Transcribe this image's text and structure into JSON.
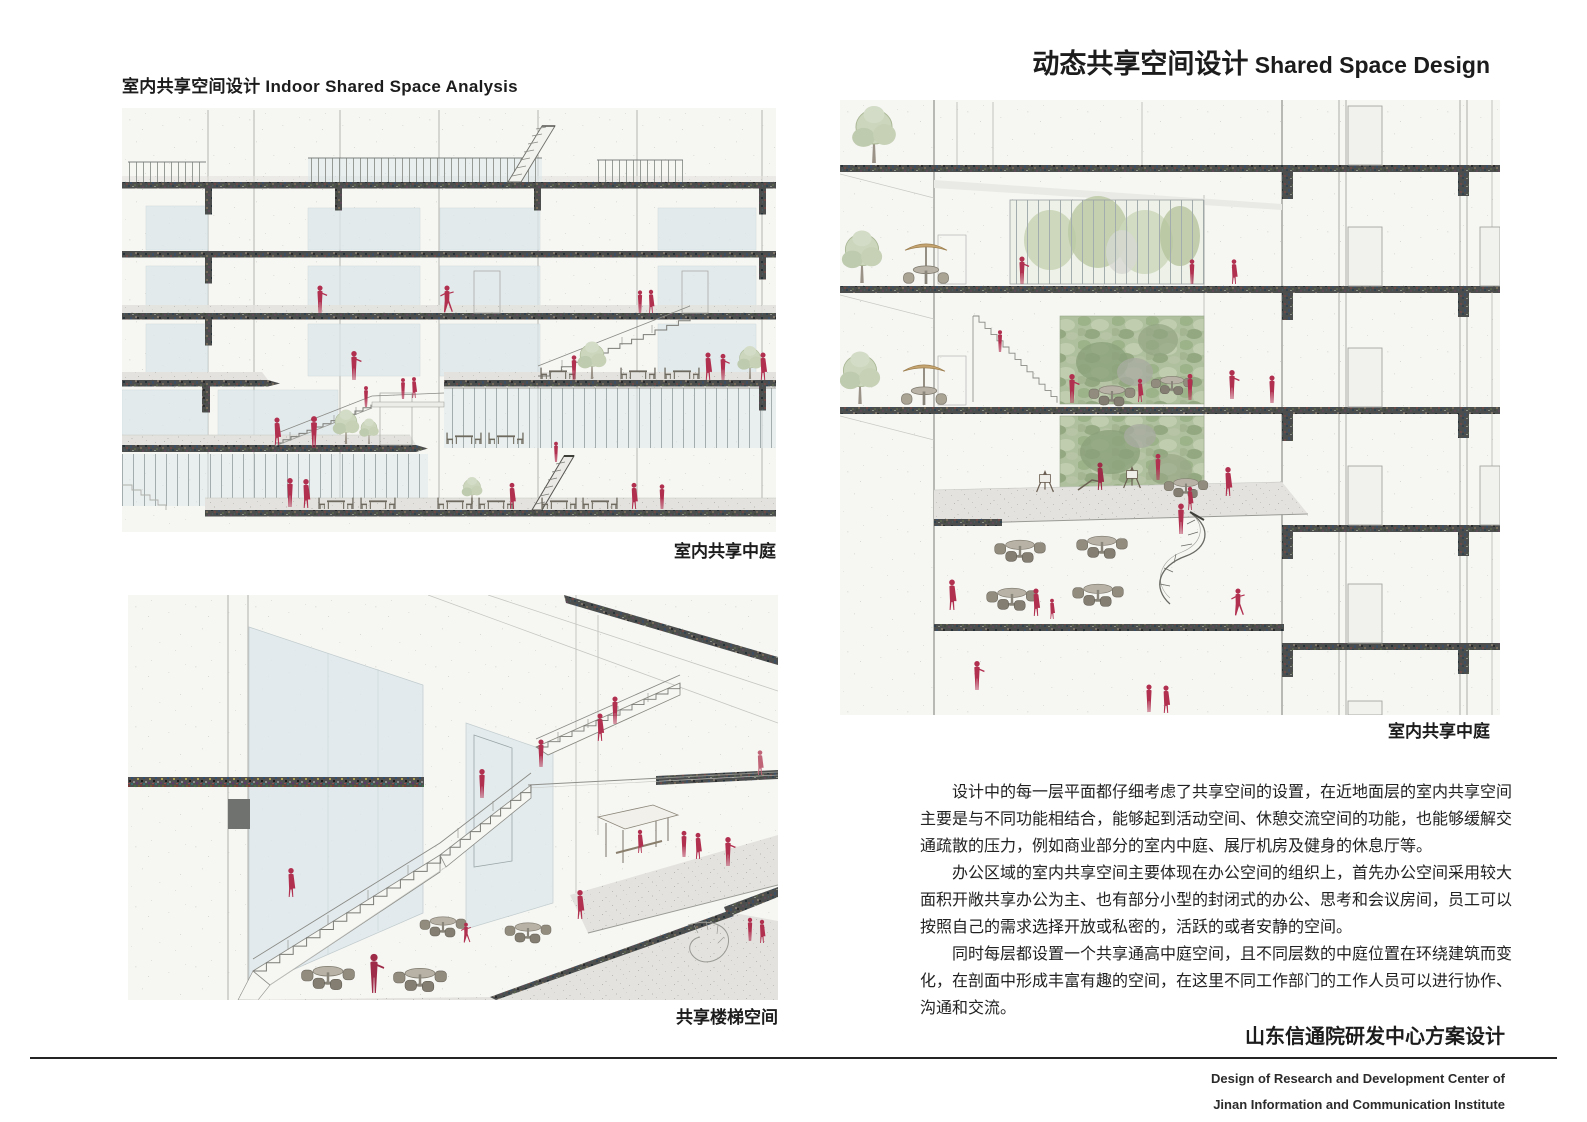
{
  "header": {
    "left_title": "室内共享空间设计 Indoor Shared Space Analysis",
    "right_title_zh": "动态共享空间设计",
    "right_title_en": " Shared Space Design"
  },
  "figures": {
    "atrium_section": {
      "caption": "室内共享中庭"
    },
    "stair_space": {
      "caption": "共享楼梯空间"
    },
    "dynamic_section": {
      "caption": "室内共享中庭"
    }
  },
  "body": {
    "paragraphs": [
      "设计中的每一层平面都仔细考虑了共享空间的设置，在近地面层的室内共享空间主要是与不同功能相结合，能够起到活动空间、休憩交流空间的功能，也能够缓解交通疏散的压力，例如商业部分的室内中庭、展厅机房及健身的休息厅等。",
      "办公区域的室内共享空间主要体现在办公空间的组织上，首先办公空间采用较大面积开敞共享办公为主、也有部分小型的封闭式的办公、思考和会议房间，员工可以按照自己的需求选择开放或私密的，活跃的或者安静的空间。",
      "同时每层都设置一个共享通高中庭空间，且不同层数的中庭位置在环绕建筑而变化，在剖面中形成丰富有趣的空间，在这里不同工作部门的工作人员可以进行协作、沟通和交流。"
    ]
  },
  "footer": {
    "project_title": "山东信通院研发中心方案设计",
    "subtitle_line1": "Design of Research and Development Center of",
    "subtitle_line2": "Jinan Information and Communication Institute"
  },
  "colors": {
    "figure_red": "#b13050",
    "slab_dark": "#4c4e4d",
    "glass_blue": "#dce7ea",
    "green_wall": "#aec09e",
    "paper": "#f6f6f3"
  }
}
